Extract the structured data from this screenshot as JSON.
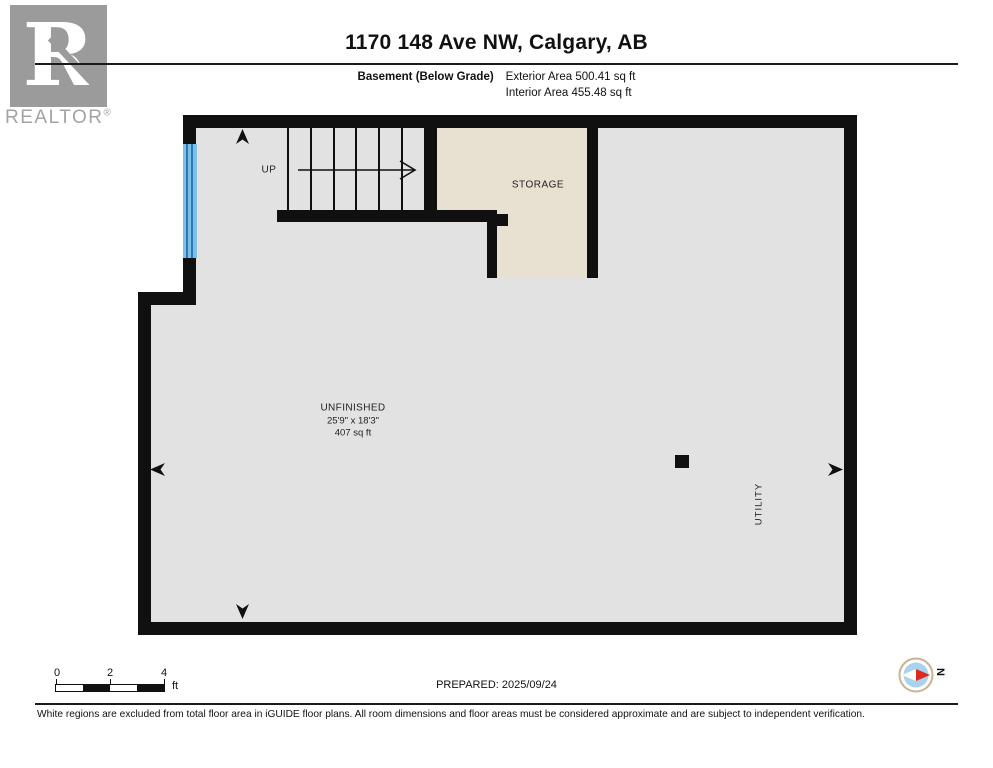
{
  "header": {
    "logo_letter": "R",
    "logo_brand": "REALTOR",
    "logo_registered": "®",
    "title": "1170 148 Ave NW, Calgary, AB",
    "floor_label": "Basement (Below Grade)",
    "exterior_area": "Exterior Area 500.41 sq ft",
    "interior_area": "Interior Area 455.48 sq ft"
  },
  "plan": {
    "up_label": "UP",
    "storage_label": "STORAGE",
    "unfinished": {
      "name": "UNFINISHED",
      "dimensions": "25'9\" x 18'3\"",
      "area": "407 sq ft"
    },
    "utility_label": "UTILITY"
  },
  "footer": {
    "scale_labels": [
      "0",
      "2",
      "4"
    ],
    "scale_unit": "ft",
    "prepared": "PREPARED: 2025/09/24",
    "compass_north": "N",
    "disclaimer": "White regions are excluded from total floor area in iGUIDE floor plans. All room dimensions and floor areas must be considered approximate and are subject to independent verification."
  },
  "colors": {
    "wall": "#101010",
    "floor_gray": "#e2e2e2",
    "storage_beige": "#e8e0d1",
    "window_blue": "#7cc0e8",
    "window_frame_blue": "#2a7ab5",
    "compass_red": "#dd2a1e",
    "compass_ring": "#c9b28f",
    "logo_gray": "#9b9b9b"
  }
}
